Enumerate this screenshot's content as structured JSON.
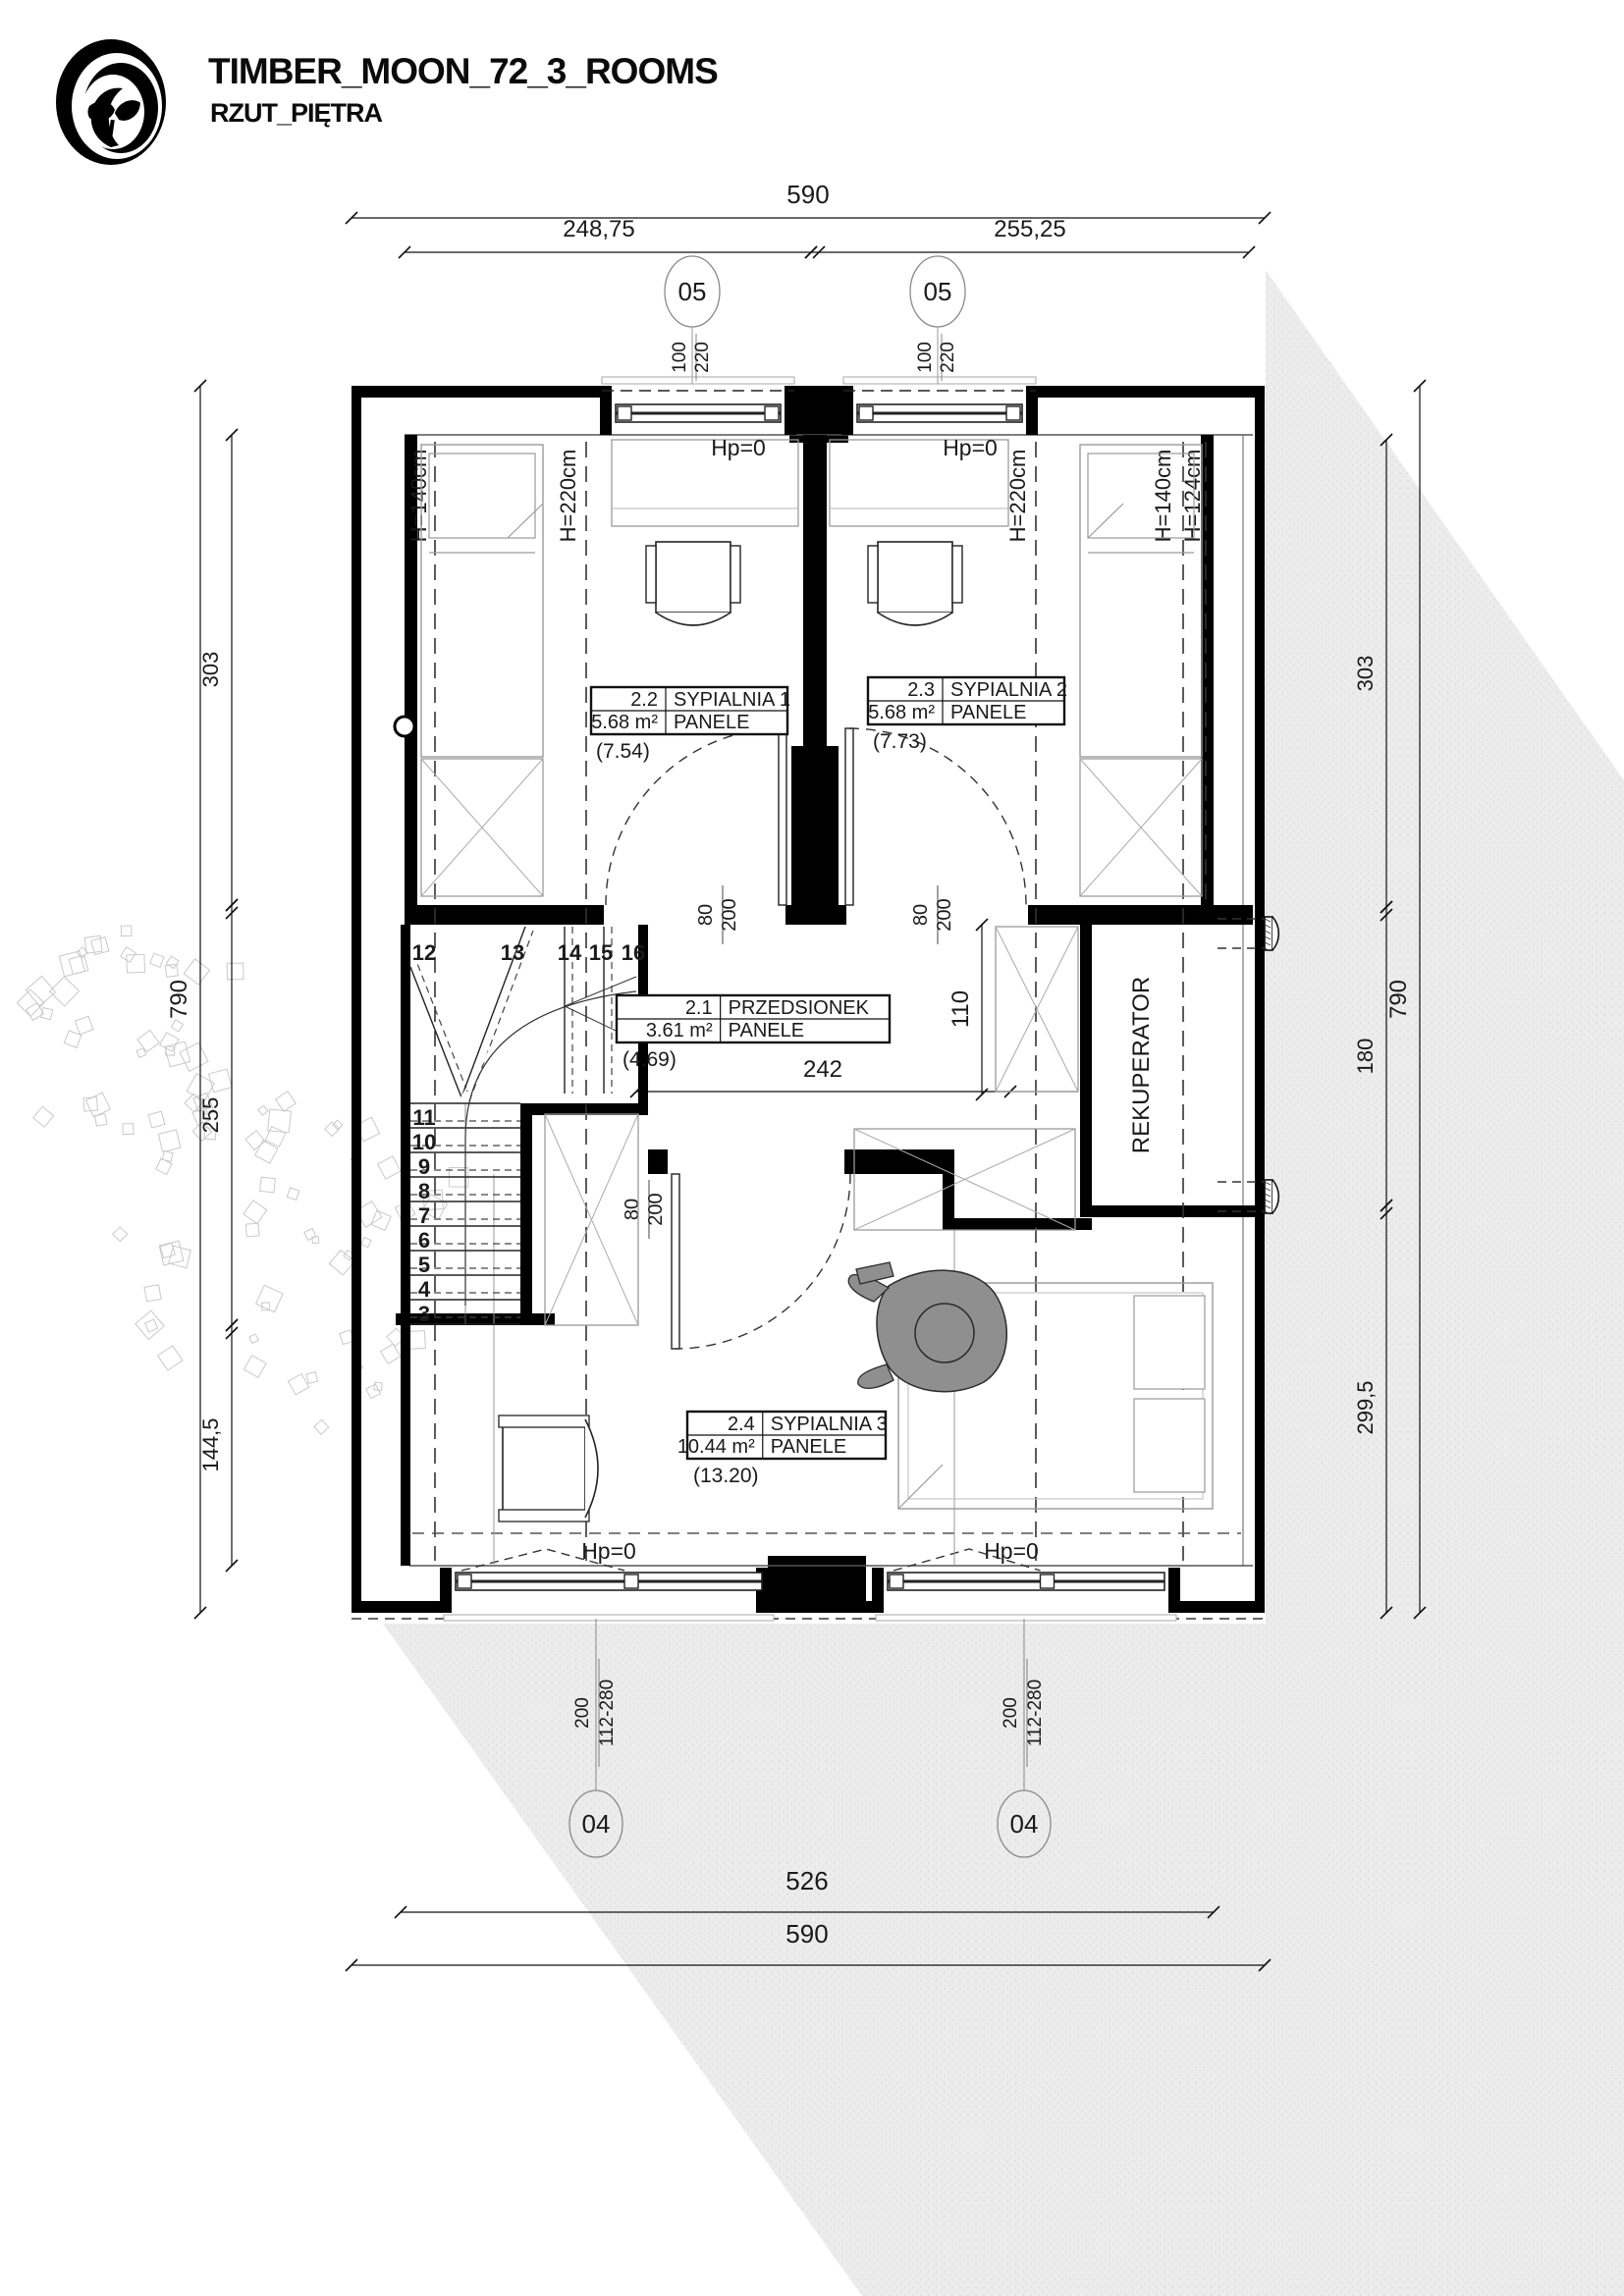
{
  "header": {
    "title": "TIMBER_MOON_72_3_ROOMS",
    "subtitle": "RZUT_PIĘTRA"
  },
  "colors": {
    "ink": "#000000",
    "roof_shade": "#ececec",
    "furniture_gray": "#9a9a9a",
    "light_gray": "#c9c9c9",
    "person_gray": "#8f8f8f",
    "marker_gray": "#8a8a8a"
  },
  "dimensions": {
    "top_total": "590",
    "top_left": "248,75",
    "top_right": "255,25",
    "left_overall": "790",
    "left_segments": [
      "303",
      "255",
      "144,5"
    ],
    "right_overall": "790",
    "right_segments": [
      "303",
      "180",
      "299,5"
    ],
    "bottom_inner": "526",
    "bottom_total": "590",
    "hall_width": "242",
    "hall_depth": "110"
  },
  "markers": {
    "top_window_code": "05",
    "top_window_w": "100",
    "top_window_h": "220",
    "bottom_window_code": "04",
    "bottom_window_w": "200",
    "bottom_window_h": "112-280",
    "door_w": "80",
    "door_h": "200"
  },
  "rooms": [
    {
      "no": "2.1",
      "name": "PRZEDSIONEK",
      "area": "3.61 m²",
      "finish": "PANELE",
      "gross": "(4.69)"
    },
    {
      "no": "2.2",
      "name": "SYPIALNIA 1",
      "area": "5.68 m²",
      "finish": "PANELE",
      "gross": "(7.54)"
    },
    {
      "no": "2.3",
      "name": "SYPIALNIA 2",
      "area": "5.68 m²",
      "finish": "PANELE",
      "gross": "(7.73)"
    },
    {
      "no": "2.4",
      "name": "SYPIALNIA 3",
      "area": "10.44 m²",
      "finish": "PANELE",
      "gross": "(13.20)"
    }
  ],
  "labels": {
    "hp": "Hp=0",
    "h140": "H=140cm",
    "h220": "H=220cm",
    "h124": "H=124cm",
    "rekuperator": "REKUPERATOR"
  },
  "stairs": {
    "treads": [
      "3",
      "4",
      "5",
      "6",
      "7",
      "8",
      "9",
      "10",
      "11",
      "12",
      "13",
      "14",
      "15",
      "16"
    ]
  }
}
